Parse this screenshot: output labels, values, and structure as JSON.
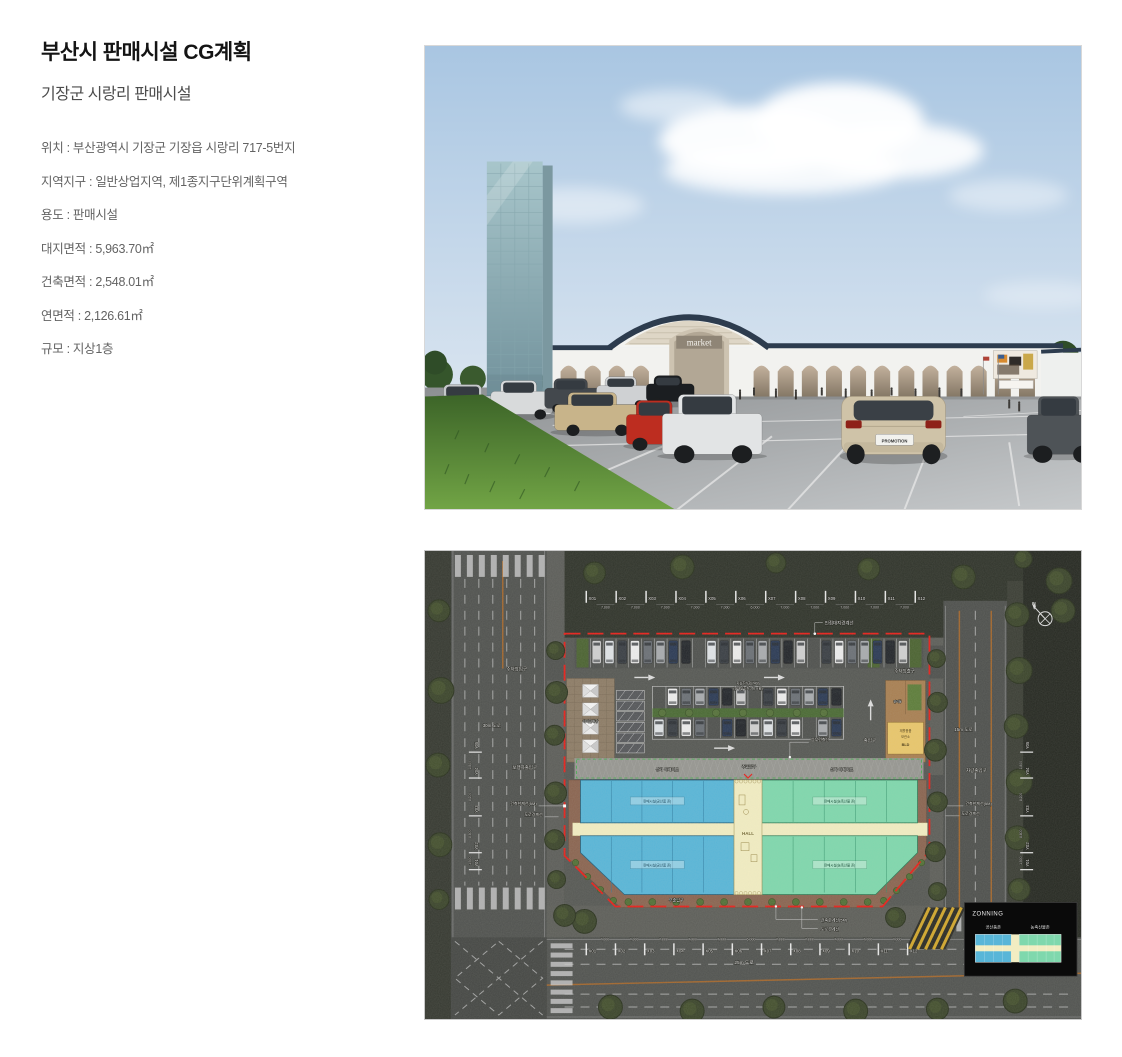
{
  "header": {
    "title": "부산시 판매시설 CG계획",
    "subtitle": "기장군 시랑리 판매시설",
    "details": [
      "위치 : 부산광역시 기장군 기장읍 시랑리 717-5번지",
      "지역지구 : 일반상업지역, 제1종지구단위계획구역",
      "용도 : 판매시설",
      "대지면적 : 5,963.70㎡",
      "건축면적 : 2,548.01㎡",
      "연면적 : 2,126.61㎡",
      "규모 : 지상1층"
    ]
  },
  "rendering": {
    "market_sign": "market",
    "license_plate": "PROMOTION"
  },
  "siteplan": {
    "north_label": "N",
    "grid": {
      "x_labels": [
        "X01",
        "X02",
        "X03",
        "X04",
        "X05",
        "X06",
        "X07",
        "X08",
        "X09",
        "X10",
        "X11",
        "X12"
      ],
      "x_dims": [
        "7,000",
        "7,000",
        "7,000",
        "7,000",
        "7,000",
        "6,000",
        "7,000",
        "7,000",
        "7,000",
        "7,000",
        "7,000"
      ],
      "y_labels": [
        "Y05",
        "Y04",
        "Y03",
        "Y02",
        "Y01"
      ],
      "y_dims": [
        "1,800",
        "8,200",
        "8,800",
        "1,500"
      ]
    },
    "labels": {
      "adjacent_boundary": "인접대지경계선",
      "parking_entrance": "주차장입구",
      "parking_exit": "주차장출구",
      "road_30m": "30m 도로",
      "road_15m": "15m 도로",
      "road_25m": "25m 도로",
      "pedestrian_entrance": "보행자출입구",
      "vehicle_entrance": "차량출입구",
      "building_limit": "건축한계선(5M)",
      "road_boundary": "도로경계선",
      "upper_building_line": "상부건축선",
      "arcade": "상가 아케이드",
      "main_entrance": "주출입구",
      "sub_entrance": "부출입구",
      "entrance": "출입구",
      "hall": "HALL",
      "plaza": "야외판매장",
      "management": "관리동",
      "management_lines": [
        "재활용품",
        "보관소",
        "BLD"
      ],
      "parking_note_1": "지상주차장(74대)",
      "parking_note_2": "(장애인주차 3대 포함)",
      "zone_blue_label": "판매시설(공산품 존)",
      "zone_green_label": "판매시설(농축산물 존)"
    },
    "zoning": {
      "title": "ZONNING",
      "items": [
        {
          "label": "공산품존",
          "color": "#58b6d8"
        },
        {
          "label": "농축산물존",
          "color": "#7fd8ad"
        }
      ]
    },
    "colors": {
      "boundary_red": "#e8201a",
      "zone_blue": "#58b6d8",
      "zone_green": "#7fd8ad",
      "hall_yellow": "#f2edc2",
      "walkway_brown": "#8a6450"
    },
    "car_palette": [
      "#ececec",
      "#cfcfcf",
      "#a8abae",
      "#3a3f45",
      "#23262b",
      "#6b7076",
      "#dfe3e6",
      "#2b3a55"
    ]
  }
}
